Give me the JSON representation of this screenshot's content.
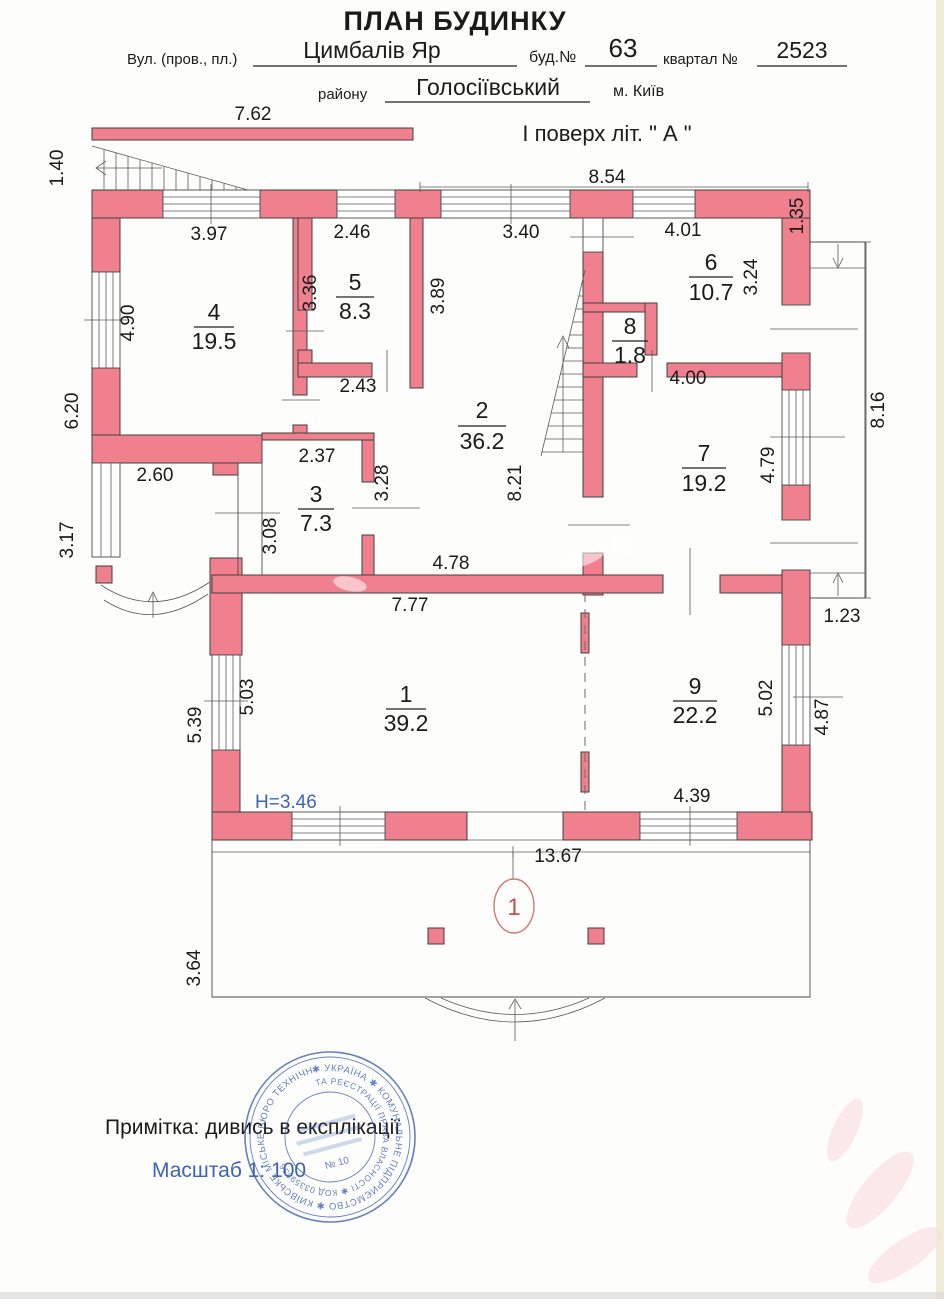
{
  "header": {
    "title": "ПЛАН БУДИНКУ",
    "street_label": "Вул. (пров., пл.)",
    "street_value": "Цимбалів Яр",
    "house_label": "буд.№",
    "house_value": "63",
    "quarter_label": "квартал №",
    "quarter_value": "2523",
    "district_label": "району",
    "district_value": "Голосіївський",
    "city": "м. Київ",
    "floor_title": "І поверх  літ. \" А \""
  },
  "plan": {
    "rooms": [
      {
        "number": "1",
        "area": "39.2"
      },
      {
        "number": "2",
        "area": "36.2"
      },
      {
        "number": "3",
        "area": "7.3"
      },
      {
        "number": "4",
        "area": "19.5"
      },
      {
        "number": "5",
        "area": "8.3"
      },
      {
        "number": "6",
        "area": "10.7"
      },
      {
        "number": "7",
        "area": "19.2"
      },
      {
        "number": "8",
        "area": "1.8"
      },
      {
        "number": "9",
        "area": "22.2"
      }
    ],
    "dims": [
      "7.62",
      "1.40",
      "8.54",
      "3.97",
      "2.46",
      "3.40",
      "4.01",
      "1.35",
      "3.36",
      "4.90",
      "3.89",
      "3.24",
      "2.43",
      "6.20",
      "4.00",
      "8.16",
      "2.37",
      "3.28",
      "2.60",
      "3.08",
      "8.21",
      "4.79",
      "3.17",
      "4.78",
      "7.77",
      "1.23",
      "5.39",
      "5.03",
      "5.02",
      "4.87",
      "4.39",
      "13.67",
      "3.64"
    ],
    "height_note": "H=3.46",
    "section_mark": "1"
  },
  "footer": {
    "note": "Примітка: дивись в експлікації",
    "scale": "Масштаб 1: 100"
  },
  "stamp": {
    "outer_text": "✱ УКРАЇНА ✱ КОМУНАЛЬНЕ ПІДПРИЄМСТВО ✱ КИЇВСЬКЕ МІСЬКЕ БЮРО ТЕХНІЧНОЇ ІНВЕНТАРИЗАЦІЇ",
    "middle_text": "ТА РЕЄСТРАЦІЇ ПРАВА ВЛАСНОСТІ ✱ КОД 03359836",
    "center_text": "№ 10"
  },
  "colors": {
    "wall": "#f1808f",
    "accent_blue": "#3f63b5",
    "accent_red": "#c9504e",
    "stamp_blue": "#4061b3"
  }
}
